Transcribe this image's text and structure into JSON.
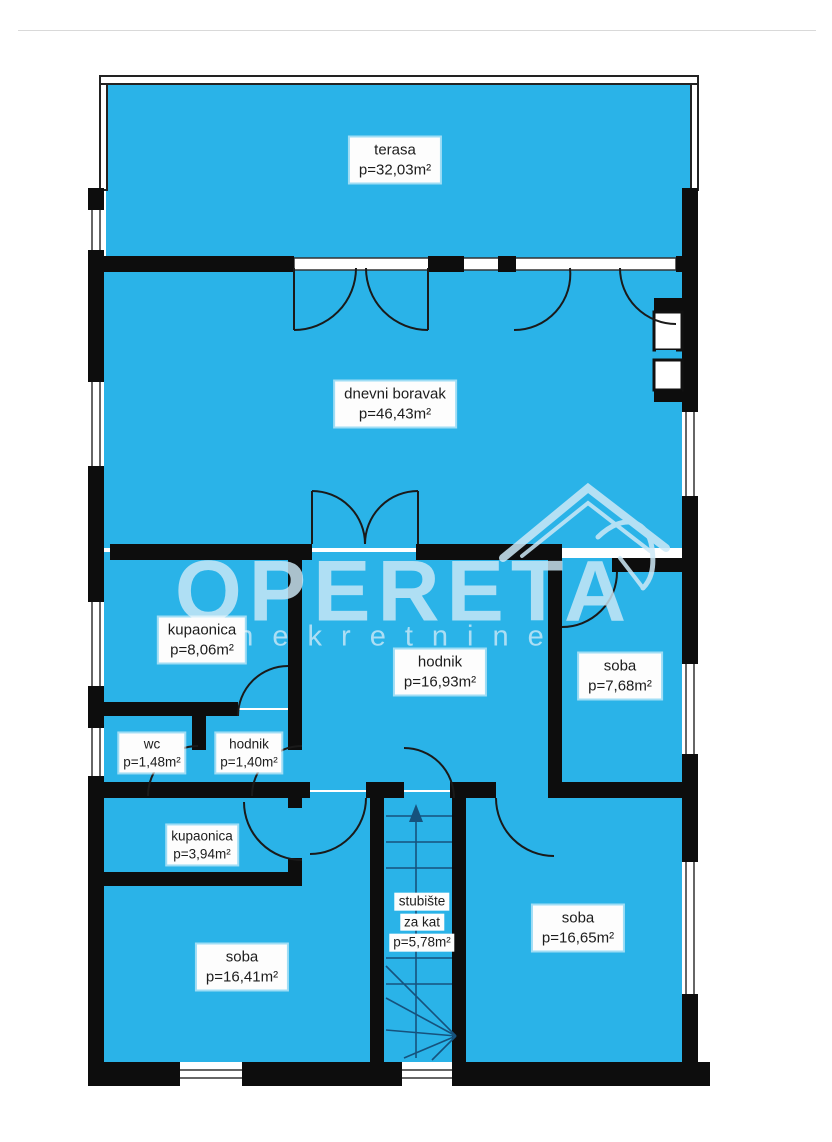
{
  "watermark": {
    "brand": "OPERETA",
    "subtitle": "nekretnine"
  },
  "plan": {
    "colors": {
      "room_fill": "#2ab3e8",
      "wall": "#0d0d0d",
      "watermark": "#cde9f7",
      "label_bg": "#fdfdfd"
    },
    "rooms": [
      {
        "id": "terasa",
        "line1": "terasa",
        "line2": "",
        "area": "p=32,03m²"
      },
      {
        "id": "dnevni-boravak",
        "line1": "dnevni boravak",
        "line2": "",
        "area": "p=46,43m²"
      },
      {
        "id": "kupaonica-1",
        "line1": "kupaonica",
        "line2": "",
        "area": "p=8,06m²"
      },
      {
        "id": "hodnik-glavni",
        "line1": "hodnik",
        "line2": "",
        "area": "p=16,93m²"
      },
      {
        "id": "soba-1",
        "line1": "soba",
        "line2": "",
        "area": "p=7,68m²"
      },
      {
        "id": "wc",
        "line1": "wc",
        "line2": "",
        "area": "p=1,48m²"
      },
      {
        "id": "hodnik-mali",
        "line1": "hodnik",
        "line2": "",
        "area": "p=1,40m²"
      },
      {
        "id": "kupaonica-2",
        "line1": "kupaonica",
        "line2": "",
        "area": "p=3,94m²"
      },
      {
        "id": "soba-2",
        "line1": "soba",
        "line2": "",
        "area": "p=16,41m²"
      },
      {
        "id": "stubiste",
        "line1": "stubište",
        "line2": "za kat",
        "area": "p=5,78m²"
      },
      {
        "id": "soba-3",
        "line1": "soba",
        "line2": "",
        "area": "p=16,65m²"
      }
    ]
  }
}
